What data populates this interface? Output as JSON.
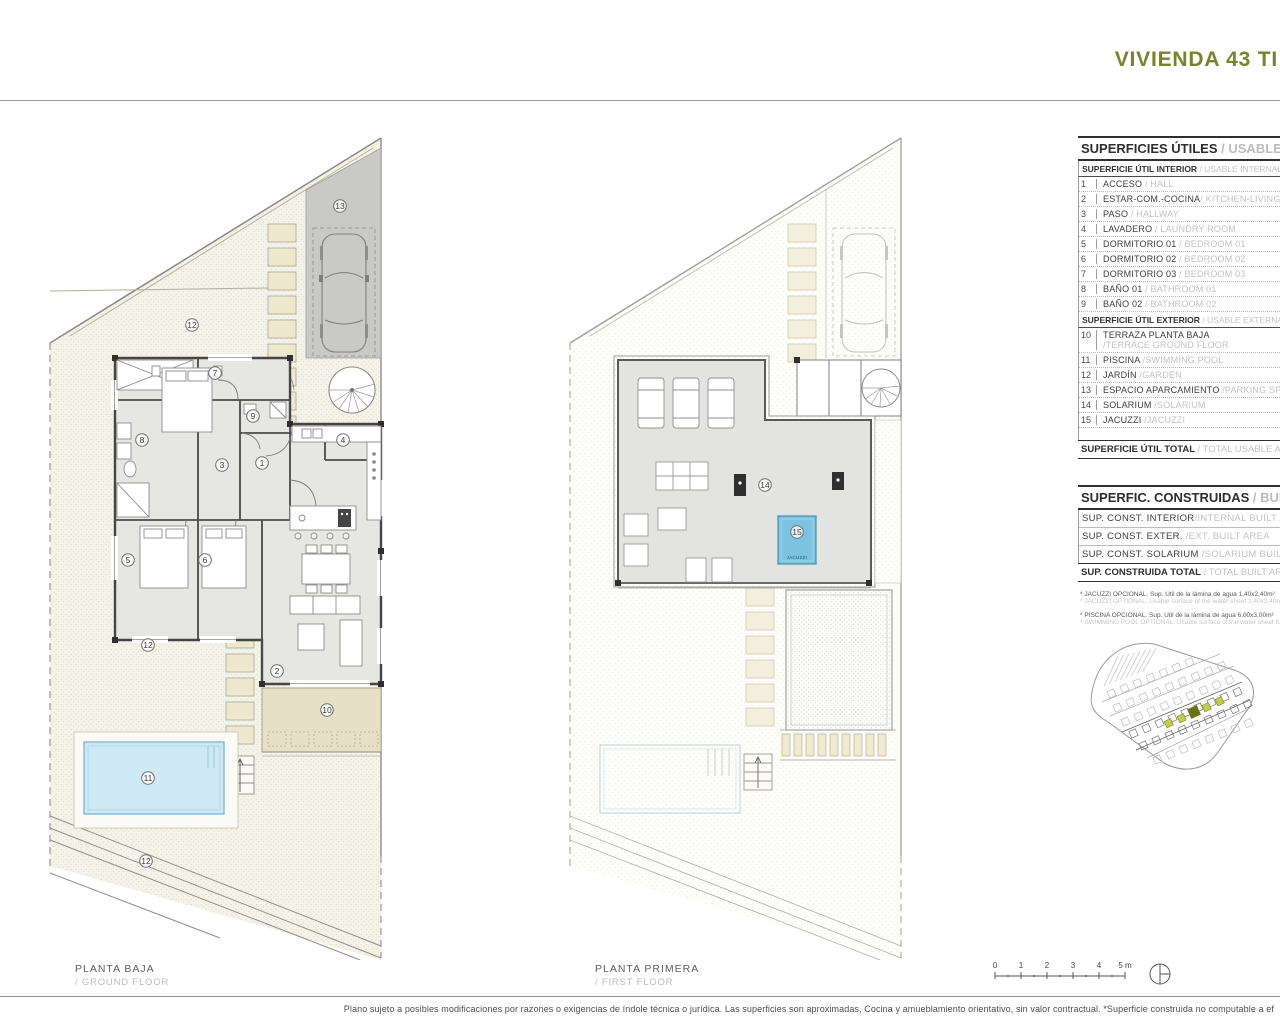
{
  "header": {
    "title": "VIVIENDA 43 TI"
  },
  "plans": {
    "ground": {
      "title_es": "PLANTA BAJA",
      "title_en": "/ GROUND FLOOR",
      "markers": [
        {
          "n": "13",
          "x": 300,
          "y": 78
        },
        {
          "n": "12",
          "x": 152,
          "y": 197
        },
        {
          "n": "7",
          "x": 175,
          "y": 245
        },
        {
          "n": "9",
          "x": 213,
          "y": 288
        },
        {
          "n": "8",
          "x": 102,
          "y": 312
        },
        {
          "n": "4",
          "x": 303,
          "y": 312
        },
        {
          "n": "1",
          "x": 222,
          "y": 335
        },
        {
          "n": "3",
          "x": 182,
          "y": 337
        },
        {
          "n": "5",
          "x": 88,
          "y": 432
        },
        {
          "n": "6",
          "x": 165,
          "y": 432
        },
        {
          "n": "12",
          "x": 108,
          "y": 517
        },
        {
          "n": "2",
          "x": 237,
          "y": 543
        },
        {
          "n": "10",
          "x": 287,
          "y": 582
        },
        {
          "n": "11",
          "x": 108,
          "y": 650
        },
        {
          "n": "12",
          "x": 106,
          "y": 733
        }
      ]
    },
    "first": {
      "title_es": "PLANTA PRIMERA",
      "title_en": "/ FIRST FLOOR",
      "jacuzzi_label": "JACUZZI",
      "markers": [
        {
          "n": "14",
          "x": 205,
          "y": 357
        },
        {
          "n": "15",
          "x": 237,
          "y": 404
        }
      ]
    }
  },
  "legend": {
    "usable": {
      "title_es": "SUPERFICIES ÚTILES",
      "title_en": " / USABLE AREA",
      "interior_header": {
        "es": "SUPERFICIE ÚTIL INTERIOR",
        "en": " / USABLE INTERNAL AREA"
      },
      "interior_rows": [
        {
          "num": "1",
          "es": "ACCESO",
          "en": " / HALL"
        },
        {
          "num": "2",
          "es": "ESTAR-COM.-COCINA",
          "en": "/ KITCHEN-LIVING"
        },
        {
          "num": "3",
          "es": "PASO",
          "en": " / HALLWAY"
        },
        {
          "num": "4",
          "es": "LAVADERO",
          "en": " / LAUNDRY ROOM"
        },
        {
          "num": "5",
          "es": "DORMITORIO 01",
          "en": " / BEDROOM 01"
        },
        {
          "num": "6",
          "es": "DORMITORIO 02",
          "en": " / BEDROOM 02"
        },
        {
          "num": "7",
          "es": "DORMITORIO 03",
          "en": " / BEDROOM 03"
        },
        {
          "num": "8",
          "es": "BAÑO 01",
          "en": " / BATHROOM 01"
        },
        {
          "num": "9",
          "es": "BAÑO 02",
          "en": " / BATHROOM 02"
        }
      ],
      "exterior_header": {
        "es": "SUPERFICIE ÚTIL EXTERIOR",
        "en": " / USABLE EXTERNAL AREA"
      },
      "exterior_rows": [
        {
          "num": "10",
          "es": "TERRAZA PLANTA BAJA",
          "en": "",
          "en2": "/TERRACE GROUND FLOOR"
        },
        {
          "num": "11",
          "es": "PISCINA",
          "en": " /SWIMMING POOL"
        },
        {
          "num": "12",
          "es": "JARDÍN",
          "en": " /GARDEN"
        },
        {
          "num": "13",
          "es": "ESPACIO APARCAMIENTO",
          "en": " /PARKING SPACE"
        },
        {
          "num": "14",
          "es": "SOLARIUM",
          "en": " /SOLARIUM"
        },
        {
          "num": "15",
          "es": "JACUZZI",
          "en": " /JACUZZI"
        }
      ],
      "total": {
        "es": "SUPERFICIE ÚTIL TOTAL",
        "en": " / TOTAL USABLE AREA"
      }
    },
    "built": {
      "title_es": "SUPERFIC. CONSTRUIDAS",
      "title_en": " / BUILT AREA",
      "rows": [
        {
          "es": "SUP. CONST. INTERIOR",
          "en": "/INTERNAL BUILT AREA"
        },
        {
          "es": "SUP. CONST. EXTER.",
          "en": " /EXT. BUILT AREA"
        },
        {
          "es": "SUP. CONST. SOLARIUM",
          "en": " /SOLARIUM BUILT AREA"
        }
      ],
      "total": {
        "es": "SUP. CONSTRUIDA TOTAL",
        "en": " / TOTAL BUILT AREA"
      }
    },
    "footnotes": [
      {
        "a": "* JACUZZI OPCIONAL. Sup. Útil de la lámina de agua 1,40x2,40m²",
        "b": "* JACUZZI OPTIONAL. Usable surface of the water sheet 1,40x2,40m²"
      },
      {
        "a": "* PISCINA OPCIONAL. Sup. Útil de la lámina de agua 6,00x3,00m²",
        "b": "* SWIMMING POOL OPTIONAL. Usable surface of the water sheet 6,00x3,00m²"
      }
    ]
  },
  "scale_bar": {
    "ticks": [
      "0",
      "1",
      "2",
      "3",
      "4",
      "5 m"
    ]
  },
  "footer": {
    "disclaimer": "Plano sujeto a posibles modificaciones por razones o exigencias de índole técnica o jurídica. Las superficies son aproximadas, Cocina y amueblamiento orientativo, sin valor contractual. *Superficie construida no computable a ef"
  },
  "colors": {
    "accent_olive": "#78832e",
    "parking_gray": "#c9c9c5",
    "terrace_beige": "#e7e0c6",
    "pool_blue": "#cfe9f4",
    "jacuzzi_blue": "#7cc3e0",
    "highlight_yellow": "#c2cb4b",
    "highlight_dark": "#66731c"
  }
}
